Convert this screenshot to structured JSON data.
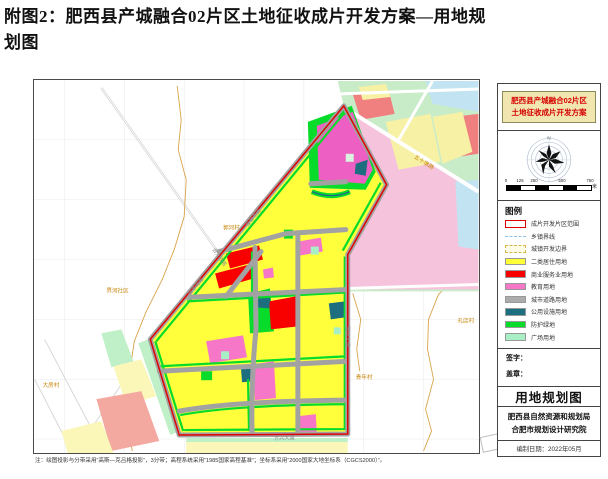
{
  "doc": {
    "title_line1": "附图2：肥西县产城融合02片区土地征收成片开发方案—用地规",
    "title_line2": "划图",
    "footnote": "注：绘图投影与分带采用“高斯—克吕格投影”，3分带；高程系统采用“1985国家高程基准”；坐标系采用“2000国家大地坐标系（CGCS2000）”。"
  },
  "sheet_panel": {
    "plan_title": {
      "line1": "肥西县产城融合02片区",
      "line2": "土地征收成片开发方案"
    },
    "compass": {
      "north_label": "N"
    },
    "scale_bar": {
      "ticks": [
        "0",
        "125",
        "250",
        "500",
        "750"
      ],
      "unit": "米"
    },
    "legend": {
      "title": "图例",
      "items": [
        {
          "label": "成片开发片区范围",
          "swatch": "outline-red"
        },
        {
          "label": "乡镇界线",
          "swatch": "line-blue"
        },
        {
          "label": "城镇开发边界",
          "swatch": "outline-dash-orange"
        },
        {
          "label": "二类居住用地",
          "swatch": "fill",
          "color": "#FFFF35"
        },
        {
          "label": "商业服务业用地",
          "swatch": "fill",
          "color": "#F80000"
        },
        {
          "label": "教育用地",
          "swatch": "fill",
          "color": "#F676C8"
        },
        {
          "label": "城市道路用地",
          "swatch": "fill",
          "color": "#ACACAC"
        },
        {
          "label": "公用设施用地",
          "swatch": "fill",
          "color": "#1D6F80"
        },
        {
          "label": "防护绿地",
          "swatch": "fill",
          "color": "#07DC2A"
        },
        {
          "label": "广场用地",
          "swatch": "fill",
          "color": "#A9EFC5"
        }
      ]
    },
    "signature_label": "签字：",
    "seal_label": "盖章：",
    "sheet_name": "用地规划图",
    "org_line1": "肥西县自然资源和规划局",
    "org_line2": "合肥市规划设计研究院",
    "date_line": "编制日期：2022年05月"
  },
  "map": {
    "road_labels": [
      {
        "text": "金寨南路",
        "x": 214,
        "y": 147,
        "rot": -50
      },
      {
        "text": "金寨南路",
        "x": 156,
        "y": 216,
        "rot": -50
      },
      {
        "text": "徽州大道",
        "x": 312,
        "y": 247,
        "rot": 90
      },
      {
        "text": "方兴大道",
        "x": 240,
        "y": 361,
        "rot": -2
      },
      {
        "text": "五十墩路",
        "x": 380,
        "y": 78,
        "rot": 32
      },
      {
        "text": "合九铁路",
        "x": 178,
        "y": 170,
        "rot": 55
      }
    ],
    "place_labels": [
      {
        "text": "郭河村",
        "x": 189,
        "y": 150
      },
      {
        "text": "界河社区",
        "x": 72,
        "y": 213
      },
      {
        "text": "大房村",
        "x": 8,
        "y": 308
      },
      {
        "text": "孔店村",
        "x": 424,
        "y": 243
      },
      {
        "text": "青年村",
        "x": 322,
        "y": 300
      }
    ],
    "colors": {
      "residential_yellow": "#FFFF3C",
      "commercial_red": "#F80000",
      "education_pink": "#F676C8",
      "road_gray": "#A2A2A2",
      "utility_teal": "#1D6F80",
      "protective_green": "#07DC2A",
      "square_lightgreen": "#A9EFC5",
      "boundary_red": "#E00000",
      "outside_pink": "#F6C3DC",
      "outside_paleyellow": "#F7F1A6",
      "outside_salmon": "#F08080",
      "outside_blue": "#C2E4F2",
      "outside_green_base": "#C8EBC8",
      "township_boundary_orange": "#D9A44A"
    }
  }
}
